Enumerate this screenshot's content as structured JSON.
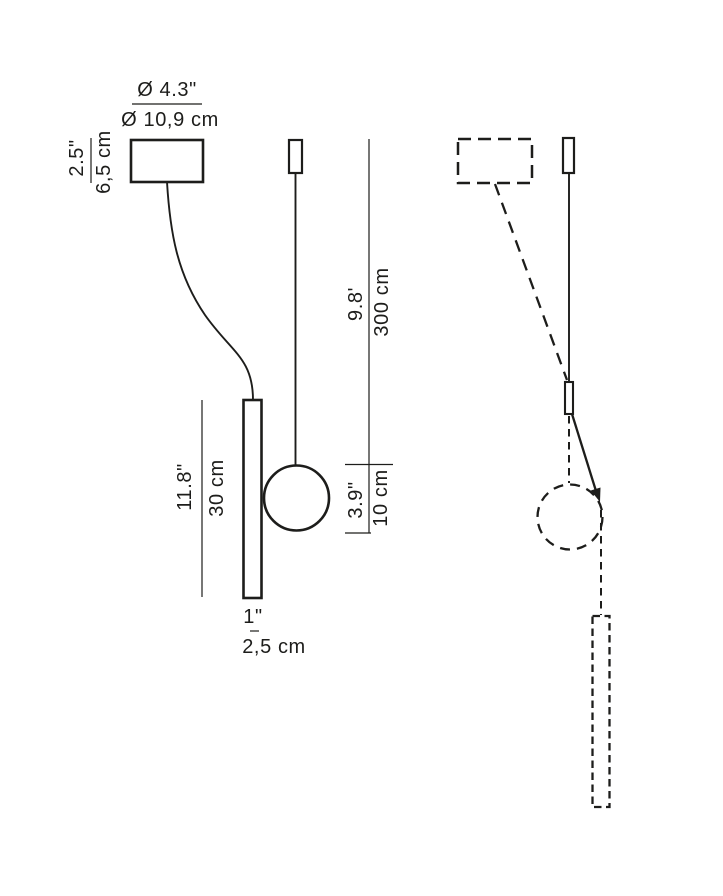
{
  "drawing": {
    "description": "Pendant lamp technical dimension drawing: front view (solid) with canopy, curved power cord, tube light, suspension cable and sphere; side view (dashed) showing tilt adjustment of the tube around the sphere pivot",
    "colors": {
      "line": "#1d1d1b",
      "background": "#ffffff"
    }
  },
  "dimensions": {
    "canopy_diameter": {
      "imperial": "Ø 4.3\"",
      "metric": "Ø 10,9 cm"
    },
    "canopy_height": {
      "imperial": "2.5\"",
      "metric": "6,5 cm"
    },
    "tube_length": {
      "imperial": "11.8\"",
      "metric": "30 cm"
    },
    "tube_diameter": {
      "imperial": "1\"",
      "metric": "2,5 cm"
    },
    "cable_length": {
      "imperial": "9.8'",
      "metric": "300 cm"
    },
    "sphere_diameter": {
      "imperial": "3.9\"",
      "metric": "10 cm"
    }
  }
}
